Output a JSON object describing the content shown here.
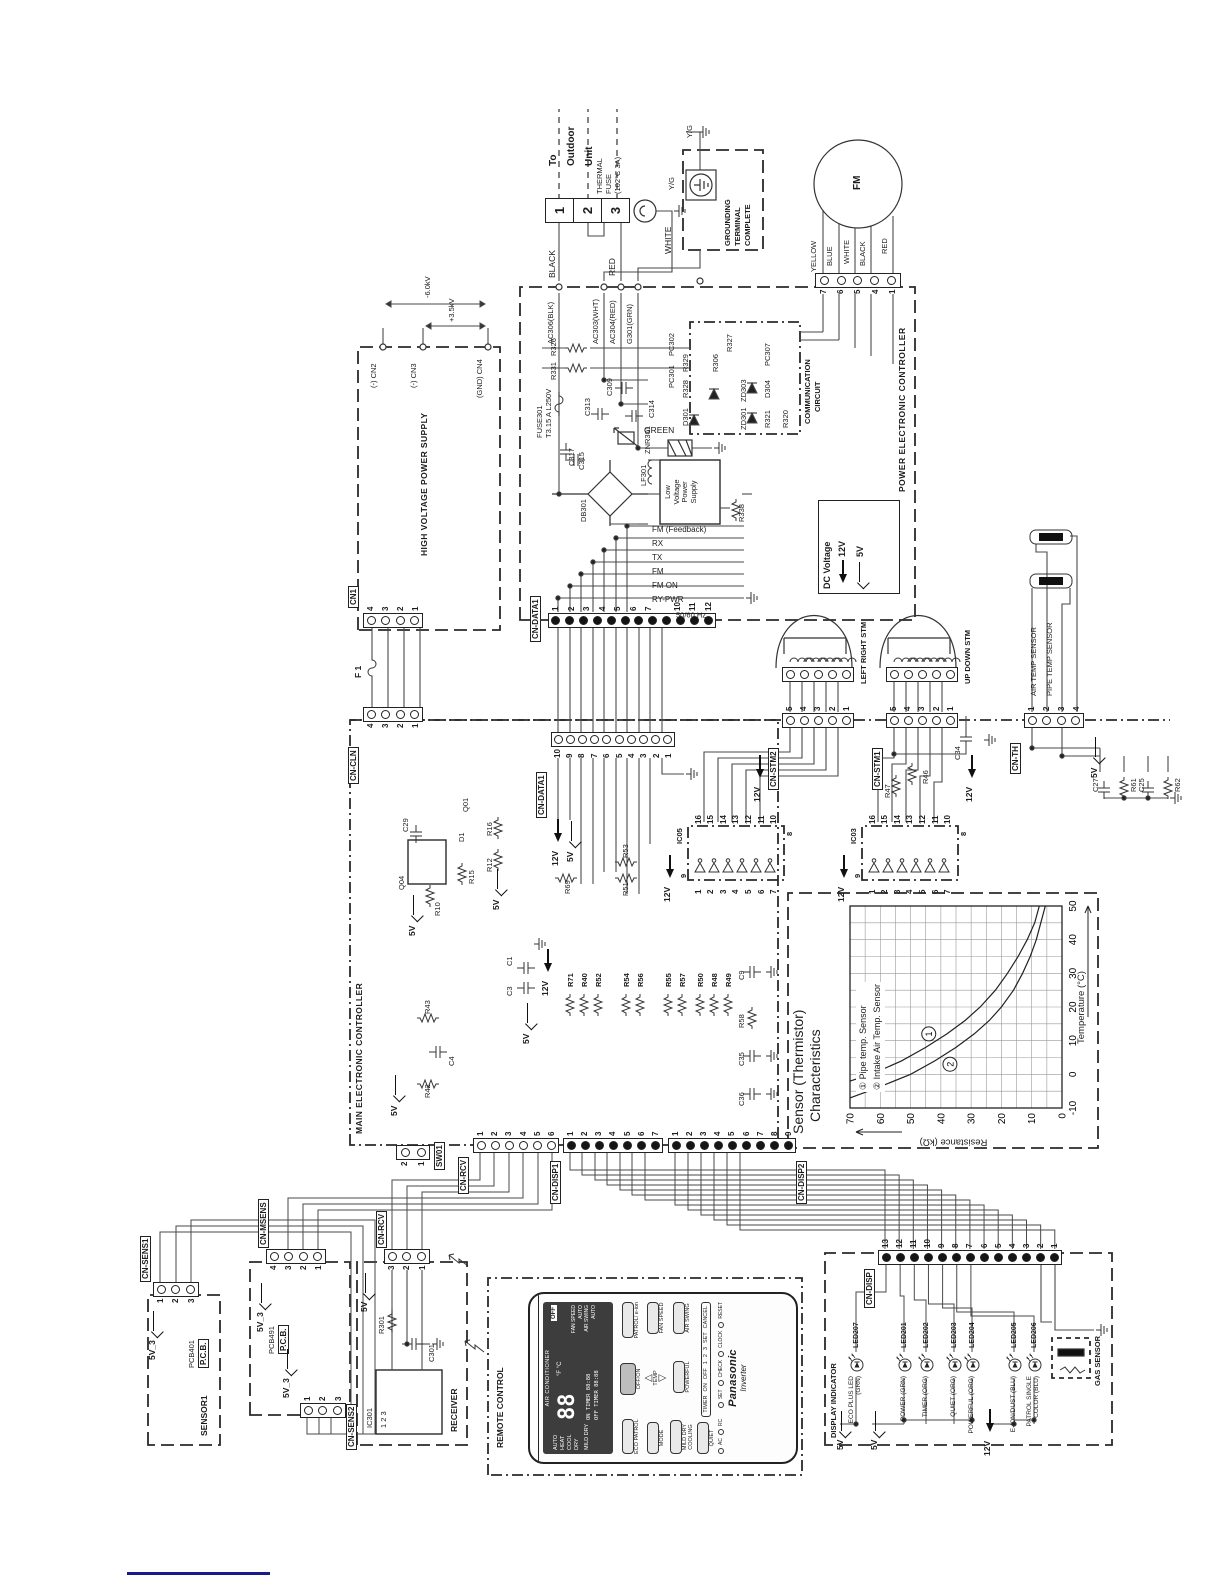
{
  "colors": {
    "ink": "#222222",
    "wire": "#4a4a4a",
    "link_line": "#1a1a8c",
    "lcd_bg": "#3d3d3d"
  },
  "outdoor": {
    "to_unit": [
      "To",
      "Outdoor",
      "Unit"
    ],
    "terminals": [
      "1",
      "2",
      "3"
    ],
    "thermal_fuse": [
      "THERMAL",
      "FUSE",
      "(102°C 3A)"
    ],
    "black": "BLACK",
    "red": "RED",
    "white": "WHITE",
    "green": "GREEN",
    "yg_a": "Y/G",
    "yg_b": "Y/G",
    "grounding": [
      "GROUNDING",
      "TERMINAL",
      "COMPLETE"
    ]
  },
  "fm": {
    "name": "FM",
    "pins": [
      "7",
      "6",
      "5",
      "4",
      "1"
    ],
    "wires": [
      "YELLOW",
      "BLUE",
      "WHITE",
      "BLACK",
      "RED"
    ]
  },
  "power": {
    "title": "POWER ELECTRONIC CONTROLLER",
    "ac": [
      "AC306(BLK)",
      "AC303(WHT)",
      "AC304(RED)",
      "G301(GRN)"
    ],
    "fuse": [
      "FUSE301",
      "T3.15 A  L250V"
    ],
    "freq": "50/60 Hz",
    "signals": [
      "RY-PWR",
      "FM ON",
      "FM",
      "TX",
      "RX",
      "FM (Feedback)"
    ],
    "parts": {
      "c317": "C317",
      "c313": "C313",
      "c314": "C314",
      "znr": "ZNR301",
      "c309": "C309",
      "lf": "LF301",
      "db": "DB301",
      "c315": "C315",
      "r338": "R338",
      "r331": "R331",
      "r326": "R326"
    },
    "lvps": [
      "Low",
      "Voltage",
      "Power",
      "Supply"
    ],
    "comm": {
      "title": [
        "COMMUNICATION",
        "CIRCUIT"
      ],
      "pc301": "PC301",
      "pc302": "PC302",
      "d301": "D301",
      "r328": "R328",
      "r329": "R329",
      "zd301": "ZD301",
      "zd303": "ZD303",
      "r306": "R306",
      "r327": "R327",
      "r321": "R321",
      "d304": "D304",
      "pc307": "PC307",
      "r320": "R320"
    },
    "cn_data1": {
      "label": "CN-DATA1",
      "pins": [
        "1",
        "2",
        "3",
        "4",
        "5",
        "6",
        "7",
        "",
        "",
        "10",
        "11",
        "12"
      ]
    },
    "legend": {
      "title": "DC Voltage",
      "v12": "12V",
      "v5": "5V"
    }
  },
  "hvps": {
    "title": "HIGH VOLTAGE POWER SUPPLY",
    "cn2": "(-) CN2",
    "cn3": "(-) CN3",
    "cn4": "(GND) CN4",
    "kv1": "-6.0kV",
    "kv2": "+3.5kV",
    "f1": "F 1",
    "cn1": {
      "label": "CN1",
      "pins": [
        "4",
        "3",
        "2",
        "1"
      ]
    }
  },
  "main": {
    "title": "MAIN ELECTRONIC CONTROLLER",
    "v12": "12V",
    "v5": "5V",
    "cn_data1": {
      "label": "CN-DATA1",
      "pins": [
        "10",
        "9",
        "8",
        "7",
        "6",
        "5",
        "4",
        "3",
        "2",
        "1"
      ]
    },
    "cn_cln": {
      "label": "CN-CLN",
      "pins": [
        "4",
        "3",
        "2",
        "1"
      ]
    },
    "sw01": {
      "label": "SW01",
      "pins": [
        "2",
        "1"
      ]
    },
    "cn_rcv": {
      "label": "CN-RCV",
      "pins": [
        "1",
        "2",
        "3",
        "4",
        "5",
        "6"
      ]
    },
    "cn_disp1": {
      "label": "CN-DISP1",
      "pins": [
        "1",
        "2",
        "3",
        "4",
        "5",
        "6",
        "7"
      ]
    },
    "cn_disp2": {
      "label": "CN-DISP2",
      "pins": [
        "1",
        "2",
        "3",
        "4",
        "5",
        "6",
        "7",
        "8",
        "9"
      ]
    },
    "res_col": [
      "R71",
      "R40",
      "R52",
      "R54",
      "R56",
      "R55",
      "R57",
      "R50",
      "R48",
      "R49"
    ],
    "parts": {
      "q04": "Q04",
      "c29": "C29",
      "r10": "R10",
      "r15": "R15",
      "d1": "D1",
      "q01": "Q01",
      "r12": "R12",
      "r16": "R16",
      "r69": "R69",
      "r51": "R51",
      "r53": "R53",
      "r42": "R42",
      "r43": "R43",
      "c4": "C4",
      "c3": "C3",
      "c1": "C1",
      "c36": "C36",
      "c35": "C35",
      "r58": "R58",
      "c9": "C9",
      "r47": "R47",
      "r46": "R46",
      "c34": "C34",
      "c27": "C27",
      "r61": "R61",
      "c25": "C25",
      "r62": "R62"
    }
  },
  "stm": {
    "ic05": {
      "label": "IC05",
      "left": [
        "1",
        "2",
        "3",
        "4",
        "5",
        "6",
        "7"
      ],
      "right": [
        "16",
        "15",
        "14",
        "13",
        "12",
        "11",
        "10"
      ],
      "p9": "9",
      "p8": "8"
    },
    "ic03": {
      "label": "IC03",
      "left": [
        "1",
        "2",
        "3",
        "4",
        "5",
        "6",
        "7"
      ],
      "right": [
        "16",
        "15",
        "14",
        "13",
        "12",
        "11",
        "10"
      ],
      "p9": "9",
      "p8": "8"
    },
    "cn_stm2": {
      "label": "CN-STM2",
      "pins": [
        "5",
        "4",
        "3",
        "2",
        "1"
      ]
    },
    "cn_stm1": {
      "label": "CN-STM1",
      "pins": [
        "5",
        "4",
        "3",
        "2",
        "1"
      ]
    },
    "lr": "LEFT RIGHT STM",
    "ud": "UP DOWN STM",
    "v12": "12V"
  },
  "th": {
    "cn": {
      "label": "CN-TH",
      "pins": [
        "1",
        "2",
        "3",
        "4"
      ]
    },
    "air": "AIR TEMP SENSOR",
    "pipe": "PIPE TEMP SENSOR",
    "v5": "5V"
  },
  "boards": {
    "sensor1": {
      "title": "SENSOR1",
      "pcb": "PCB401",
      "pcb2": "P.C.B.",
      "v": "5V_3",
      "cn": {
        "label": "CN-SENS1",
        "pins": [
          "1",
          "2",
          "3"
        ]
      }
    },
    "pcb491": {
      "pcb": "PCB491",
      "pcb2": "P.C.B.",
      "v1": "5V_3",
      "v2": "5V_3",
      "cn_msens": {
        "label": "CN-MSENS",
        "pins": [
          "4",
          "3",
          "2",
          "1"
        ]
      },
      "cn_sens2": {
        "label": "CN-SENS2",
        "pins": [
          "1",
          "2",
          "3"
        ]
      }
    },
    "receiver": {
      "title": "RECEIVER",
      "ic": "IC301",
      "r301": "R301",
      "c301": "C301",
      "v5": "5V",
      "cn": {
        "label": "CN-RCV",
        "pins": [
          "3",
          "2",
          "1"
        ]
      },
      "ic_pins": "1  2  3"
    }
  },
  "display": {
    "title": "DISPLAY INDICATOR",
    "cn": {
      "label": "CN-DISP",
      "pins": [
        "13",
        "12",
        "11",
        "10",
        "9",
        "8",
        "7",
        "6",
        "5",
        "4",
        "3",
        "2",
        "1"
      ]
    },
    "v5a": "5V",
    "v5b": "5V",
    "v12": "12V",
    "gas": "GAS SENSOR",
    "leds": [
      {
        "id": "LED207",
        "fn": "ECO PLUS LED (GRN)"
      },
      {
        "id": "LED201",
        "fn": "POWER (GRN)"
      },
      {
        "id": "LED202",
        "fn": "TIMER (ORG)"
      },
      {
        "id": "LED203",
        "fn": "QUIET (ORG)"
      },
      {
        "id": "LED204",
        "fn": "POWERFUL (ORG)"
      },
      {
        "id": "LED205",
        "fn": "E-ION/DUST (BLU)"
      },
      {
        "id": "LED206",
        "fn": "PATROL SINGLE COLOR (BLU)"
      }
    ]
  },
  "remote": {
    "title": "REMOTE CONTROL",
    "brand": "Panasonic",
    "sub": "Inverter",
    "lcd": {
      "head": "AIR CONDITIONER",
      "off": "OFF",
      "temp": "88",
      "units": "°F °C",
      "modes": [
        "AUTO",
        "HEAT",
        "COOL",
        "DRY",
        "MILD DRY"
      ],
      "on_t": "ON TIMER  88:88",
      "off_t": "OFF TIMER 88:88",
      "fan": "FAN SPEED",
      "swing": "AIR SWING",
      "auto": "AUTO"
    },
    "btns": {
      "offon": "OFF/ON",
      "eco": "ECO PATROL",
      "patrol": "PATROL/ e-ion",
      "fan": "FAN SPEED",
      "mode": "MODE",
      "mild": "MILD DRY COOLING",
      "temp": "TEMP",
      "swing": "AIR SWING",
      "powerful": "POWERFUL",
      "quiet": "QUIET",
      "timer": "TIMER",
      "on": "ON",
      "off": "OFF",
      "n1": "1",
      "n2": "2",
      "n3": "3",
      "set": "SET",
      "cancel": "CANCEL",
      "ac": "AC",
      "rc": "RC",
      "t1": "SET",
      "t2": "CHECK",
      "t3": "CLOCK",
      "t4": "RESET"
    }
  },
  "chart_data": {
    "type": "line",
    "title": [
      "Sensor (Thermistor)",
      "Characteristics"
    ],
    "xlabel": "Temperature (°C)",
    "ylabel": "Resistance (kΩ)",
    "xlim": [
      -10,
      50
    ],
    "ylim": [
      0,
      70
    ],
    "grid_step": 5,
    "xticks": [
      -10,
      0,
      10,
      20,
      30,
      40,
      50
    ],
    "yticks": [
      0,
      10,
      20,
      30,
      40,
      50,
      60,
      70
    ],
    "legend": [
      "① Pipe temp. Sensor",
      "② Intake Air Temp. Sensor"
    ],
    "legend_position": "upper-left",
    "grid": true,
    "series": [
      {
        "name": "Pipe temp. Sensor",
        "marker": "1",
        "marker_at": [
          12,
          44
        ],
        "points": [
          [
            -2,
            70
          ],
          [
            0,
            63
          ],
          [
            4,
            53
          ],
          [
            8,
            45
          ],
          [
            12,
            38
          ],
          [
            16,
            32
          ],
          [
            20,
            27
          ],
          [
            25,
            22
          ],
          [
            30,
            18
          ],
          [
            35,
            14.5
          ],
          [
            40,
            11.5
          ],
          [
            45,
            9
          ],
          [
            50,
            7.5
          ]
        ]
      },
      {
        "name": "Intake Air Temp. Sensor",
        "marker": "2",
        "marker_at": [
          3,
          37
        ],
        "points": [
          [
            -7,
            70
          ],
          [
            -4,
            61
          ],
          [
            0,
            50
          ],
          [
            4,
            42
          ],
          [
            8,
            35
          ],
          [
            12,
            29
          ],
          [
            16,
            24
          ],
          [
            20,
            20
          ],
          [
            25,
            16
          ],
          [
            30,
            13
          ],
          [
            35,
            10.5
          ],
          [
            40,
            8.5
          ],
          [
            45,
            7
          ],
          [
            50,
            5.5
          ]
        ]
      }
    ]
  }
}
